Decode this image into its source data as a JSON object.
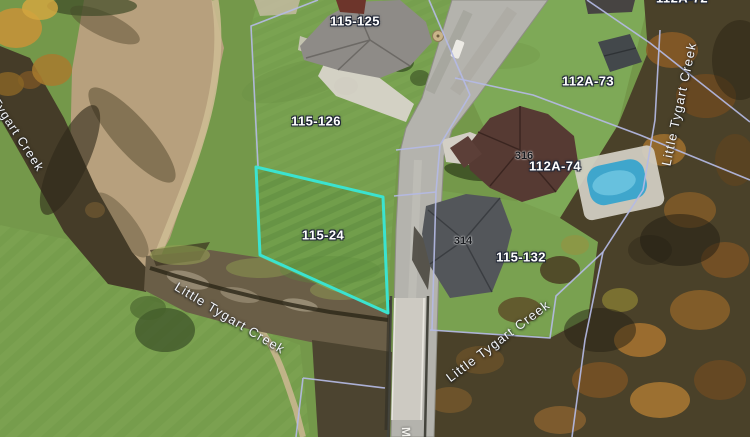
{
  "view": {
    "highlighted_parcel_id": "115-24"
  },
  "parcel_labels": [
    {
      "text": "115-125"
    },
    {
      "text": "115-126"
    },
    {
      "text": "112A-73"
    },
    {
      "text": "112A-74"
    },
    {
      "text": "115-24"
    },
    {
      "text": "115-132"
    },
    {
      "text": "112A-72"
    }
  ],
  "address_labels": [
    {
      "text": "316"
    },
    {
      "text": "314"
    }
  ],
  "waterway_labels": [
    {
      "text": "Tygart Creek"
    },
    {
      "text": "Little Tygart Creek"
    },
    {
      "text": "Little Tygart Creek"
    },
    {
      "text": "Little Tygart Creek"
    }
  ],
  "road_marking": {
    "text": "M"
  },
  "colors": {
    "parcel_line": "#b4bae4",
    "highlight_outline": "#3be3cf",
    "parcel_label_text": "#ffffff",
    "parcel_label_halo": "#222838",
    "address_label_text": "#17191d",
    "waterway_label_text": "#f3f5f9",
    "pool_water": "#3fa6cc"
  }
}
